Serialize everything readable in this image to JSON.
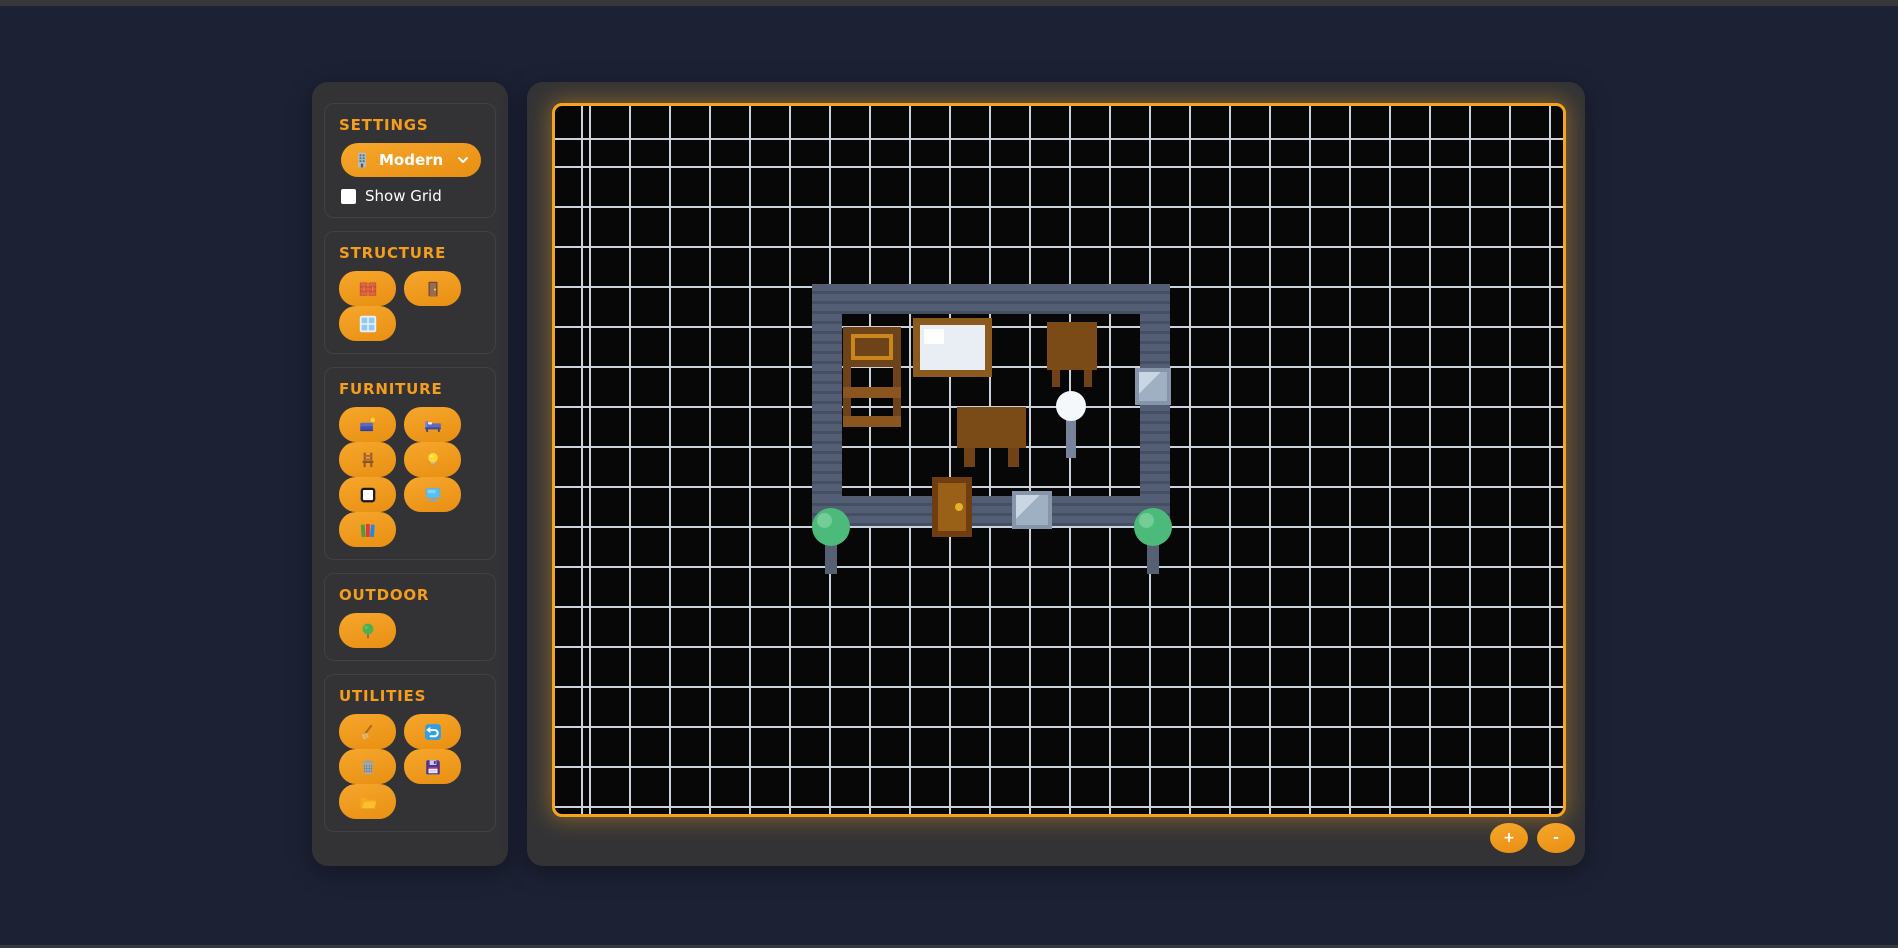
{
  "app": {
    "colors": {
      "background": "#1c2134",
      "panel": "#333336",
      "accent_orange": "#f5a01f",
      "header_text": "#f59d1c",
      "wall": "#535d73",
      "wall_stripe": "#454f63",
      "wood_dark": "#6f431a",
      "wood_mid": "#8a551e",
      "window_frame": "#8795ab",
      "window_pane": "#9fb0c3",
      "window_glint": "#c9d6e3",
      "door_frame": "#6e3d12",
      "door_fill": "#996018",
      "door_knob": "#e8b02b",
      "tree_green": "#4cba7b",
      "tree_highlight": "#74cd97",
      "trunk_gray": "#566072",
      "lamp_bulb": "#f4f8fb",
      "lamp_stem": "#76839a",
      "grid_line": "#ccd2db",
      "canvas_bg": "#070708"
    }
  },
  "sidebar": {
    "sections": [
      {
        "id": "settings",
        "title": "SETTINGS",
        "theme_dropdown": {
          "selected": "Modern",
          "icon": "building-icon"
        },
        "show_grid": {
          "label": "Show Grid",
          "checked": false
        }
      },
      {
        "id": "structure",
        "title": "STRUCTURE",
        "tools": [
          {
            "id": "wall",
            "icon": "brick-icon"
          },
          {
            "id": "door",
            "icon": "door-icon"
          },
          {
            "id": "window",
            "icon": "window-icon"
          }
        ]
      },
      {
        "id": "furniture",
        "title": "FURNITURE",
        "tools": [
          {
            "id": "couch",
            "icon": "couch-icon"
          },
          {
            "id": "bed",
            "icon": "bed-icon"
          },
          {
            "id": "chair",
            "icon": "chair-icon"
          },
          {
            "id": "lamp",
            "icon": "bulb-icon"
          },
          {
            "id": "table",
            "icon": "frame-icon"
          },
          {
            "id": "computer",
            "icon": "monitor-icon"
          },
          {
            "id": "bookshelf",
            "icon": "books-icon"
          }
        ]
      },
      {
        "id": "outdoor",
        "title": "OUTDOOR",
        "tools": [
          {
            "id": "tree",
            "icon": "tree-icon"
          }
        ]
      },
      {
        "id": "utilities",
        "title": "UTILITIES",
        "tools": [
          {
            "id": "eraser",
            "icon": "broom-icon"
          },
          {
            "id": "undo",
            "icon": "undo-icon"
          },
          {
            "id": "clear",
            "icon": "trash-icon"
          },
          {
            "id": "save",
            "icon": "floppy-icon"
          },
          {
            "id": "load",
            "icon": "folder-icon"
          }
        ]
      }
    ]
  },
  "canvas": {
    "grid": {
      "cell": 40,
      "offset_x": 34,
      "offset_y": 34,
      "visible": true
    },
    "zoom_controls": {
      "zoom_in": "+",
      "zoom_out": "-"
    },
    "scene": [
      {
        "type": "wall",
        "name": "wall-top",
        "x": 257,
        "y": 178,
        "w": 358,
        "h": 30
      },
      {
        "type": "wall",
        "name": "wall-left",
        "x": 257,
        "y": 178,
        "w": 30,
        "h": 242
      },
      {
        "type": "wall",
        "name": "wall-right",
        "x": 585,
        "y": 178,
        "w": 30,
        "h": 242
      },
      {
        "type": "wall",
        "name": "wall-bottom",
        "x": 257,
        "y": 390,
        "w": 358,
        "h": 30
      },
      {
        "type": "dresser",
        "name": "dresser",
        "x": 288,
        "y": 221,
        "w": 58,
        "h": 40
      },
      {
        "type": "board",
        "name": "whiteboard",
        "x": 358,
        "y": 212,
        "w": 79,
        "h": 59
      },
      {
        "type": "table",
        "name": "desk",
        "x": 492,
        "y": 216,
        "w": 50,
        "h": 48,
        "leg_w": 8,
        "leg_h": 17,
        "leg_x1": 5,
        "leg_x2": 37
      },
      {
        "type": "chair",
        "name": "chair",
        "x": 288,
        "y": 261,
        "w": 58,
        "h": 60
      },
      {
        "type": "table",
        "name": "table",
        "x": 402,
        "y": 301,
        "w": 69,
        "h": 41,
        "leg_w": 11,
        "leg_h": 19,
        "leg_x1": 7,
        "leg_x2": 51
      },
      {
        "type": "lamp",
        "name": "floor-lamp",
        "x": 501,
        "y": 285,
        "w": 30,
        "h": 67
      },
      {
        "type": "window",
        "name": "window-right",
        "x": 580,
        "y": 262,
        "w": 36,
        "h": 37
      },
      {
        "type": "window",
        "name": "window-bottom",
        "x": 457,
        "y": 385,
        "w": 40,
        "h": 38
      },
      {
        "type": "door",
        "name": "door",
        "x": 377,
        "y": 371,
        "w": 40,
        "h": 60
      },
      {
        "type": "tree",
        "name": "tree-left",
        "x": 257,
        "y": 402,
        "w": 38,
        "h": 66
      },
      {
        "type": "tree",
        "name": "tree-right",
        "x": 579,
        "y": 402,
        "w": 38,
        "h": 66
      }
    ]
  }
}
